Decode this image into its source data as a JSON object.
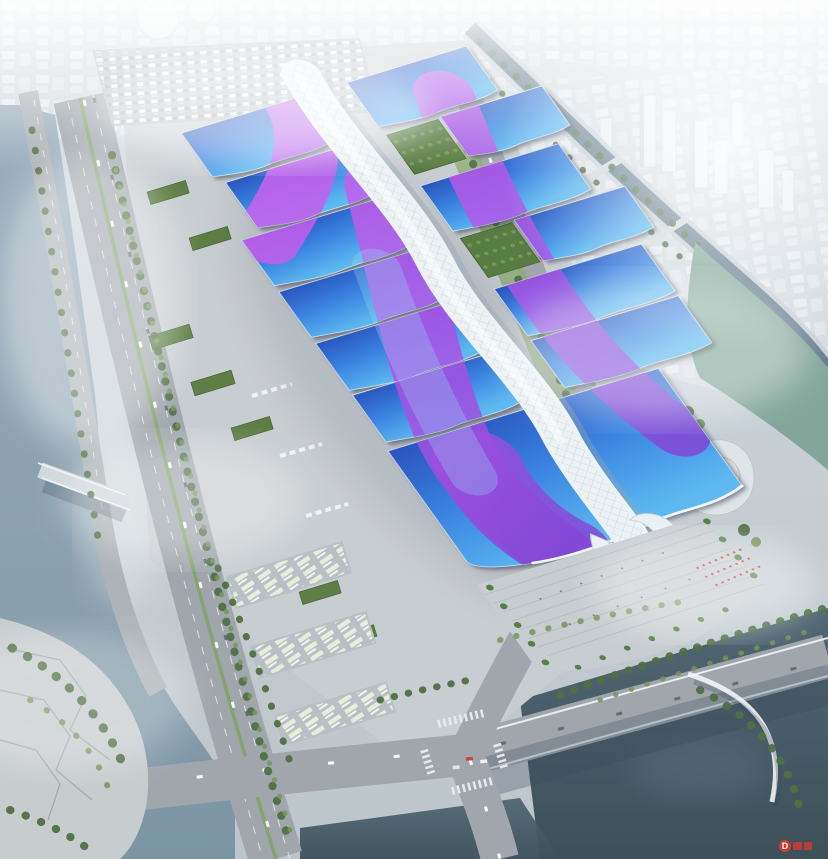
{
  "scene": {
    "title": "Aerial rendering of a riverside exhibition and convention center",
    "description": "Bird's-eye architectural rendering: rows of exhibition halls with blue wave roofs crossed by purple ribbon bands, joined by a sinuous white central concourse that ends in a curled entrance shell at a stepped plaza with palm trees and a red visitor formation. The campus is bounded by boulevards, bus and truck aprons, canals and rivers, with a hazy white city skyline beyond and a red watermark in the lower right corner."
  },
  "watermark": {
    "symbol": "D"
  },
  "palette": {
    "bg-top": "#cfd9e1",
    "bg-mid": "#c3ccd2",
    "bg-bot": "#b9c2c8",
    "city-base": "#d3dae0",
    "city-block-a": "#e9eef1",
    "city-block-b": "#e0e7eb",
    "haze": "#ffffff",
    "water-left-a": "#97abb9",
    "water-left-b": "#76909f",
    "water-dark-a": "#47606c",
    "water-dark-b": "#334751",
    "water-green": "#7ca294",
    "canal": "#5d7688",
    "road": "#9ba2a8",
    "road-minor": "#a9afb4",
    "lane": "#f0f2f4",
    "apron": "#c6cbcf",
    "parking": "#b6bdc2",
    "median-green": "#7d9d62",
    "tree-dark": "#47683c",
    "tree-light": "#6f8f54",
    "lawn": "#8aa86b",
    "warehouse-roof": "#55783b",
    "garden": "#50773a",
    "roof-deep": "#1d4cba",
    "roof-blue": "#2f7ade",
    "roof-cyan": "#55b6f0",
    "ribbon-a": "#d95ff0",
    "ribbon-b": "#a74ae4",
    "ribbon-c": "#6d38cc",
    "ribbon-sheen": "#8fd8f4",
    "spine": "#edf2f5",
    "spine-grid": "#c9d5dd",
    "spine-shadow": "#8fa2ae",
    "hall-edge": "#dcebf4",
    "eave": "#eff6fa",
    "plaza": "#c6cbcf",
    "step": "#aeb5ba",
    "palm": "#4c7a3f",
    "people-red": "#cc3a32",
    "people-dark": "#596066",
    "building-white": "#dde3e7",
    "building-line": "#b9c2c8",
    "bridge": "#cfd5d9",
    "shadow": "#2e3c50",
    "watermark": "#d03a30"
  }
}
